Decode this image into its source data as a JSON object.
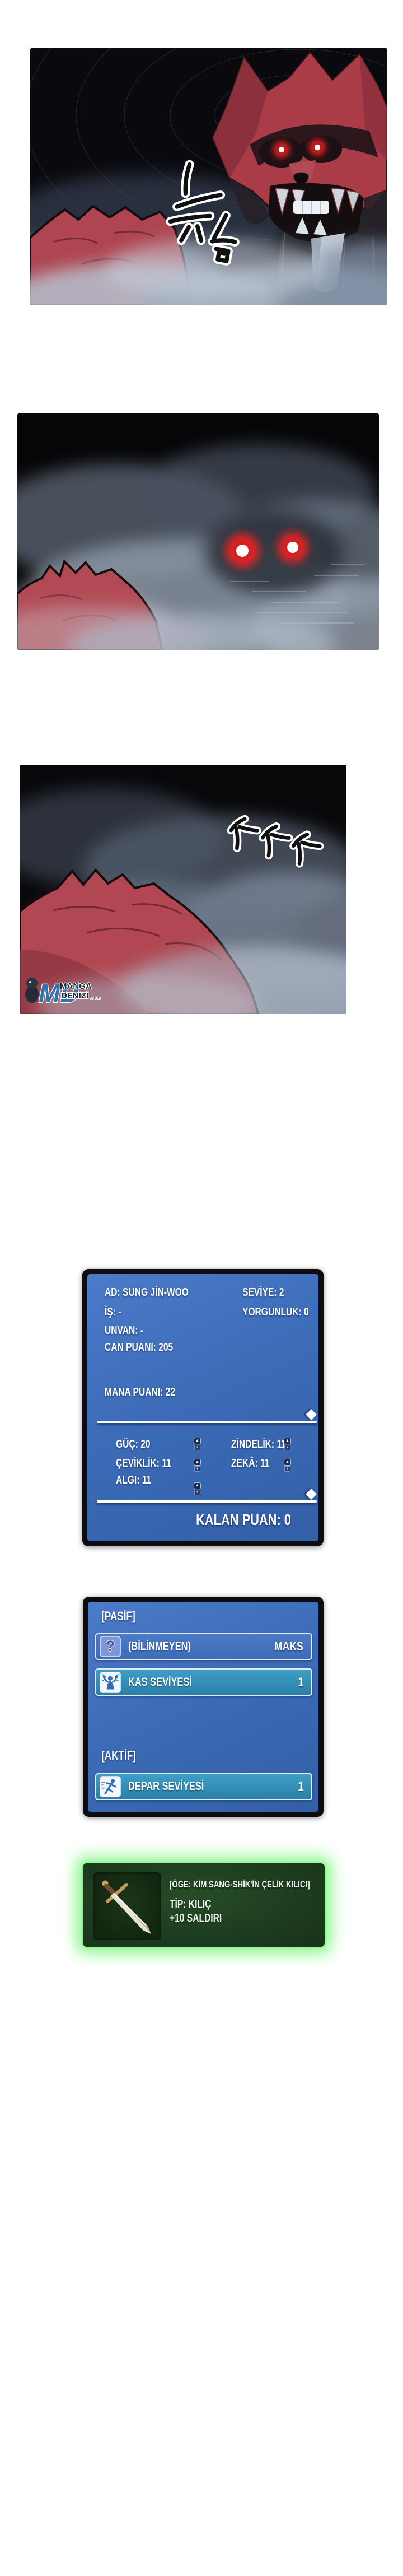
{
  "status_window": {
    "info_left": [
      "AD: SUNG JİN-WOO",
      "İŞ: -",
      "UNVAN: -",
      "CAN PUANI: 205",
      "MANA PUANI: 22"
    ],
    "info_right": [
      "SEVİYE: 2",
      "YORGUNLUK: 0"
    ],
    "stats_left": [
      "GÜÇ: 20",
      "ÇEVİKLİK: 11",
      "ALGI: 11"
    ],
    "stats_right": [
      "ZİNDELİK: 11",
      "ZEKÂ: 11"
    ],
    "remaining_label": "KALAN PUAN: 0",
    "spinner_up": "▲",
    "spinner_down": "▼"
  },
  "skill_window": {
    "passive_header": "[PASİF]",
    "active_header": "[AKTİF]",
    "passive_rows": [
      {
        "icon": "question-icon",
        "icon_glyph": "?",
        "name": "(BİLİNMEYEN)",
        "level": "MAKS"
      },
      {
        "icon": "muscle-icon",
        "name": "KAS SEVİYESİ",
        "level": "1"
      }
    ],
    "active_rows": [
      {
        "icon": "runner-icon",
        "name": "DEPAR SEVİYESİ",
        "level": "1"
      }
    ]
  },
  "item_window": {
    "icon": "sword-icon",
    "title": "[ÖGE: KİM SANG-SHİK'İN ÇELİK KILICI]",
    "type_line": "TİP: KILIÇ",
    "bonus_line": "+10 SALDIRI"
  },
  "watermark": {
    "initials": "MD",
    "line1": "MANGA",
    "line2": "DENİZİ",
    "suffix": ".com"
  },
  "art": {
    "sfx_panel1": "growl-strokes",
    "sfx_panel3": "footstep-strokes",
    "colors": {
      "window_blue": "#3c6cb8",
      "row_teal": "#2f8db4",
      "item_green": "#1e3d20",
      "glow_green": "#3dfc3d",
      "eye_red": "#ff2020",
      "wolf_red": "#ae4450"
    }
  }
}
